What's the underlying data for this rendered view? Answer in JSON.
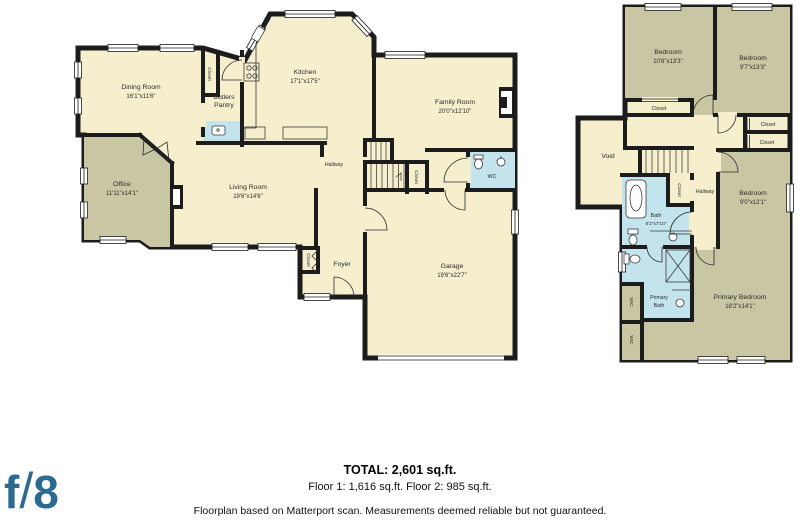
{
  "colors": {
    "wall": "#1c1c1c",
    "room_cream": "#f5efce",
    "room_olive": "#c9c7a3",
    "room_bath_blue": "#c4e4ed",
    "logo_blue": "#2d6a92",
    "background": "#ffffff"
  },
  "logo": {
    "f": "f",
    "slash": "/",
    "eight": "8"
  },
  "summary": {
    "total": "TOTAL: 2,601 sq.ft.",
    "floors": "Floor 1: 1,616 sq.ft. Floor 2: 985 sq.ft.",
    "disclaimer": "Floorplan based on Matterport scan. Measurements deemed reliable but not guaranteed."
  },
  "floor1": {
    "rooms": {
      "dining": {
        "name": "Dining Room",
        "dims": "16'1\"x11'6\""
      },
      "office": {
        "name": "Office",
        "dims": "11'11\"x14'1\""
      },
      "butlers": {
        "line1": "Butlers",
        "line2": "Pantry"
      },
      "kitchen": {
        "name": "Kitchen",
        "dims": "17'1\"x17'5\""
      },
      "family": {
        "name": "Family Room",
        "dims": "20'0\"x12'10\""
      },
      "living": {
        "name": "Living Room",
        "dims": "19'6\"x14'6\""
      },
      "hallway": {
        "name": "Hallway"
      },
      "wc": {
        "name": "WC"
      },
      "foyer": {
        "name": "Foyer"
      },
      "garage": {
        "name": "Garage",
        "dims": "19'6\"x22'7\""
      },
      "closet_stairs": {
        "name": "Closet"
      },
      "closet_foyer": {
        "name": "Closet"
      },
      "closet_pantry": {
        "name": "Closet"
      }
    }
  },
  "floor2": {
    "rooms": {
      "bedroom1": {
        "name": "Bedroom",
        "dims": "10'8\"x13'3\""
      },
      "bedroom2": {
        "name": "Bedroom",
        "dims": "9'7\"x13'3\""
      },
      "bedroom3": {
        "name": "Bedroom",
        "dims": "9'0\"x12'1\""
      },
      "primary_bedroom": {
        "name": "Primary Bedroom",
        "dims": "18'2\"x14'1\""
      },
      "bath": {
        "name": "Bath",
        "dims": "8'2\"x7'10\""
      },
      "primary_bath": {
        "line1": "Primary",
        "line2": "Bath"
      },
      "void": {
        "name": "Void"
      },
      "hallway": {
        "name": "Hallway"
      },
      "closet_bed1": {
        "name": "Closet"
      },
      "closet_a": {
        "name": "Closet"
      },
      "closet_b": {
        "name": "Closet"
      },
      "closet_bath": {
        "name": "Closet"
      },
      "wic1": {
        "name": "WIC"
      },
      "wic2": {
        "name": "WIC"
      }
    }
  }
}
